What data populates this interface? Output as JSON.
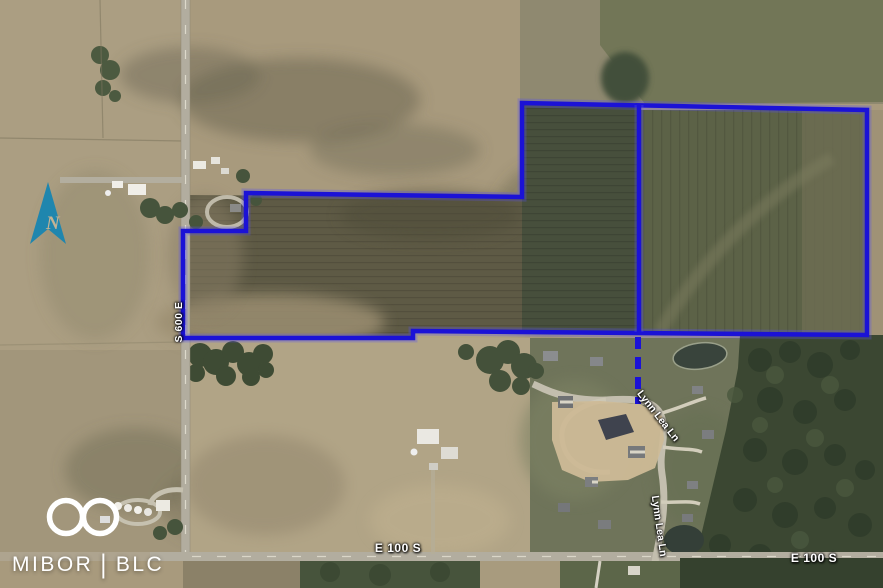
{
  "map": {
    "description": "Aerial parcel map with outlined property boundary over farmland",
    "boundary_color": "#1b12d6",
    "north_arrow_color": "#1f86ae",
    "north_arrow_label": "N",
    "boundary": {
      "main_polygon": [
        [
          522,
          103
        ],
        [
          867,
          110
        ],
        [
          867,
          335
        ],
        [
          413,
          331
        ],
        [
          413,
          338
        ],
        [
          183,
          338
        ],
        [
          183,
          231
        ],
        [
          246,
          231
        ],
        [
          246,
          193
        ],
        [
          522,
          197
        ]
      ],
      "interior_line": [
        [
          639,
          105
        ],
        [
          639,
          332
        ]
      ],
      "dashed_line": {
        "x1": 638,
        "y1": 337,
        "x2": 638,
        "y2": 404
      }
    },
    "road_labels": [
      {
        "text": "S 600 E",
        "orientation": "vertical"
      },
      {
        "text": "E 100 S",
        "orientation": "horizontal"
      },
      {
        "text": "E 100 S",
        "orientation": "horizontal"
      },
      {
        "text": "Lynn Lea Ln",
        "orientation": "diagonal"
      },
      {
        "text": "Lynn Lea Ln",
        "orientation": "near-vertical"
      }
    ],
    "watermark": {
      "brand_left": "MIBOR",
      "divider": "|",
      "brand_right": "BLC"
    }
  }
}
